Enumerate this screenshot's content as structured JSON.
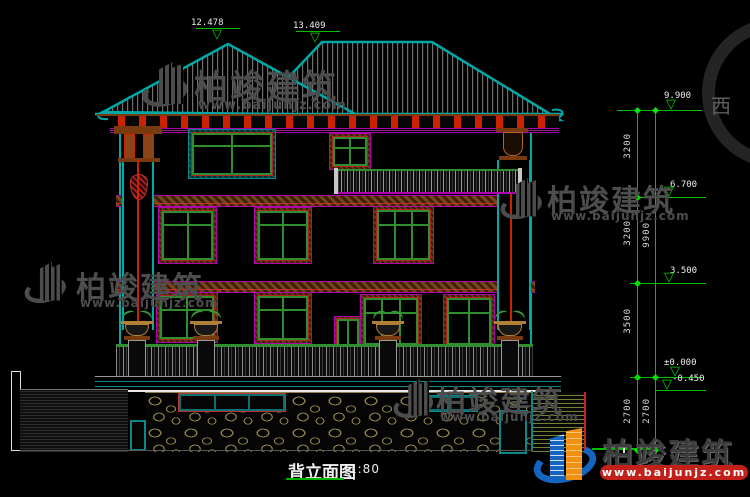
{
  "drawing": {
    "title": "背立面图",
    "scale": "1:80"
  },
  "elevation_markers": {
    "roof_left": "12.478",
    "roof_right": "13.409",
    "eave": "9.900",
    "floor3": "6.700",
    "floor2": "3.500",
    "ground": "±0.000",
    "terrace": "-0.450"
  },
  "dimension_chain": {
    "inner_segments": [
      "3200",
      "3200",
      "3500",
      "2700"
    ],
    "outer_segments": [
      "9900",
      "2700"
    ]
  },
  "watermark": {
    "brand": "柏竣建筑",
    "url": "www.baijunjz.com",
    "stamp": "西"
  },
  "icons": {
    "elevation_triangle": "▽"
  },
  "colors": {
    "background": "#000000",
    "dimension_green": "#00c000",
    "outline_cyan": "#00a8a8",
    "trim_magenta": "#b000b0",
    "corbel_red": "#cc2200",
    "frame_green": "#2f8f2f",
    "stone_tan": "#8f7f48",
    "logo_blue": "#1565c0",
    "logo_orange": "#f29111"
  }
}
